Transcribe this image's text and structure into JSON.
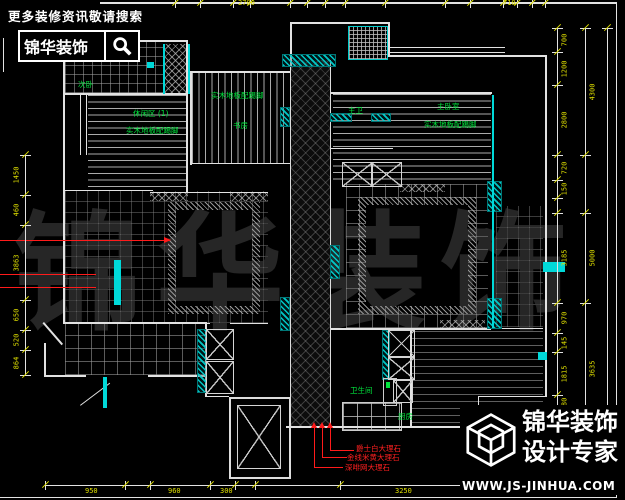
{
  "branding": {
    "top_left": {
      "slogan": "更多装修资讯敬请搜索",
      "brand": "锦华装饰"
    },
    "bottom_right": {
      "brand": "锦华装饰",
      "tagline": "设计专家",
      "website": "WWW.JS-JINHUA.COM"
    }
  },
  "watermark": {
    "text": "锦华装饰"
  },
  "plan": {
    "room_labels": [
      {
        "text": "次卧",
        "x": 78,
        "y": 81
      },
      {
        "text": "休闲区 (1)",
        "x": 133,
        "y": 110
      },
      {
        "text": "实木地板配踢脚",
        "x": 126,
        "y": 127
      },
      {
        "text": "实木地板配踢脚",
        "x": 211,
        "y": 92
      },
      {
        "text": "书房",
        "x": 233,
        "y": 122
      },
      {
        "text": "主卫",
        "x": 348,
        "y": 107
      },
      {
        "text": "主卧室",
        "x": 437,
        "y": 103
      },
      {
        "text": "实木地板配踢脚",
        "x": 424,
        "y": 121
      },
      {
        "text": "卫生间",
        "x": 350,
        "y": 387
      },
      {
        "text": "厨房",
        "x": 398,
        "y": 413
      }
    ],
    "material_callouts": [
      {
        "text": "爵士白大理石",
        "x": 356,
        "y": 445
      },
      {
        "text": "金线米黄大理石",
        "x": 347,
        "y": 454
      },
      {
        "text": "深啡网大理石",
        "x": 345,
        "y": 464
      }
    ]
  },
  "dimensions": {
    "vertical": [
      {
        "x": 557,
        "text_dx": 8,
        "segs": [
          {
            "y1": 28,
            "y2": 52,
            "v": "700"
          },
          {
            "y1": 52,
            "y2": 85,
            "v": "1200"
          },
          {
            "y1": 85,
            "y2": 155,
            "v": "2800"
          },
          {
            "y1": 155,
            "y2": 180,
            "v": "720"
          },
          {
            "y1": 180,
            "y2": 198,
            "v": "150"
          },
          {
            "y1": 213,
            "y2": 303,
            "v": "3185"
          },
          {
            "y1": 303,
            "y2": 333,
            "v": "970"
          },
          {
            "y1": 333,
            "y2": 352,
            "v": "145"
          },
          {
            "y1": 352,
            "y2": 395,
            "v": "1815"
          },
          {
            "y1": 395,
            "y2": 412,
            "v": "280"
          },
          {
            "y1": 412,
            "y2": 434,
            "v": "785"
          }
        ]
      },
      {
        "x": 585,
        "text_dx": 8,
        "segs": [
          {
            "y1": 28,
            "y2": 155,
            "v": "4300"
          },
          {
            "y1": 213,
            "y2": 303,
            "v": "5000"
          },
          {
            "y1": 303,
            "y2": 434,
            "v": "3635"
          }
        ]
      },
      {
        "x": 607,
        "text_dx": 7,
        "segs": [
          {
            "y1": 28,
            "y2": 478,
            "v": "13665",
            "ly": 465
          }
        ]
      },
      {
        "x": 25,
        "text_dx": -8,
        "segs": [
          {
            "y1": 155,
            "y2": 195,
            "v": "1450"
          },
          {
            "y1": 195,
            "y2": 225,
            "v": "460"
          },
          {
            "y1": 225,
            "y2": 300,
            "v": "3863"
          },
          {
            "y1": 300,
            "y2": 330,
            "v": "650"
          },
          {
            "y1": 330,
            "y2": 350,
            "v": "520"
          },
          {
            "y1": 350,
            "y2": 375,
            "v": "864"
          }
        ]
      }
    ],
    "horizontal": [
      {
        "y": 485,
        "x1": 45,
        "x2": 545,
        "label_dy": 3,
        "ticks": [
          45,
          125,
          150,
          210,
          235,
          255,
          340,
          480,
          545
        ],
        "labels": [
          {
            "x": 85,
            "v": "950"
          },
          {
            "x": 168,
            "v": "960"
          },
          {
            "x": 220,
            "v": "300"
          },
          {
            "x": 395,
            "v": "3250"
          }
        ]
      },
      {
        "y": 3,
        "x1": 100,
        "x2": 616,
        "label_dy": -3,
        "ticks": [
          175,
          200,
          233,
          250,
          290,
          307,
          325,
          345,
          385,
          445,
          470,
          503,
          517,
          532,
          545
        ],
        "labels": [
          {
            "x": 238,
            "v": "2700"
          },
          {
            "x": 503,
            "v": "710"
          }
        ]
      }
    ]
  },
  "colors": {
    "label_green": "#00e43c",
    "dim_yellow": "#e0e000",
    "annotation_red": "#ff2020",
    "wall_cyan": "#00cccc",
    "line_white": "#e2e2e2"
  }
}
